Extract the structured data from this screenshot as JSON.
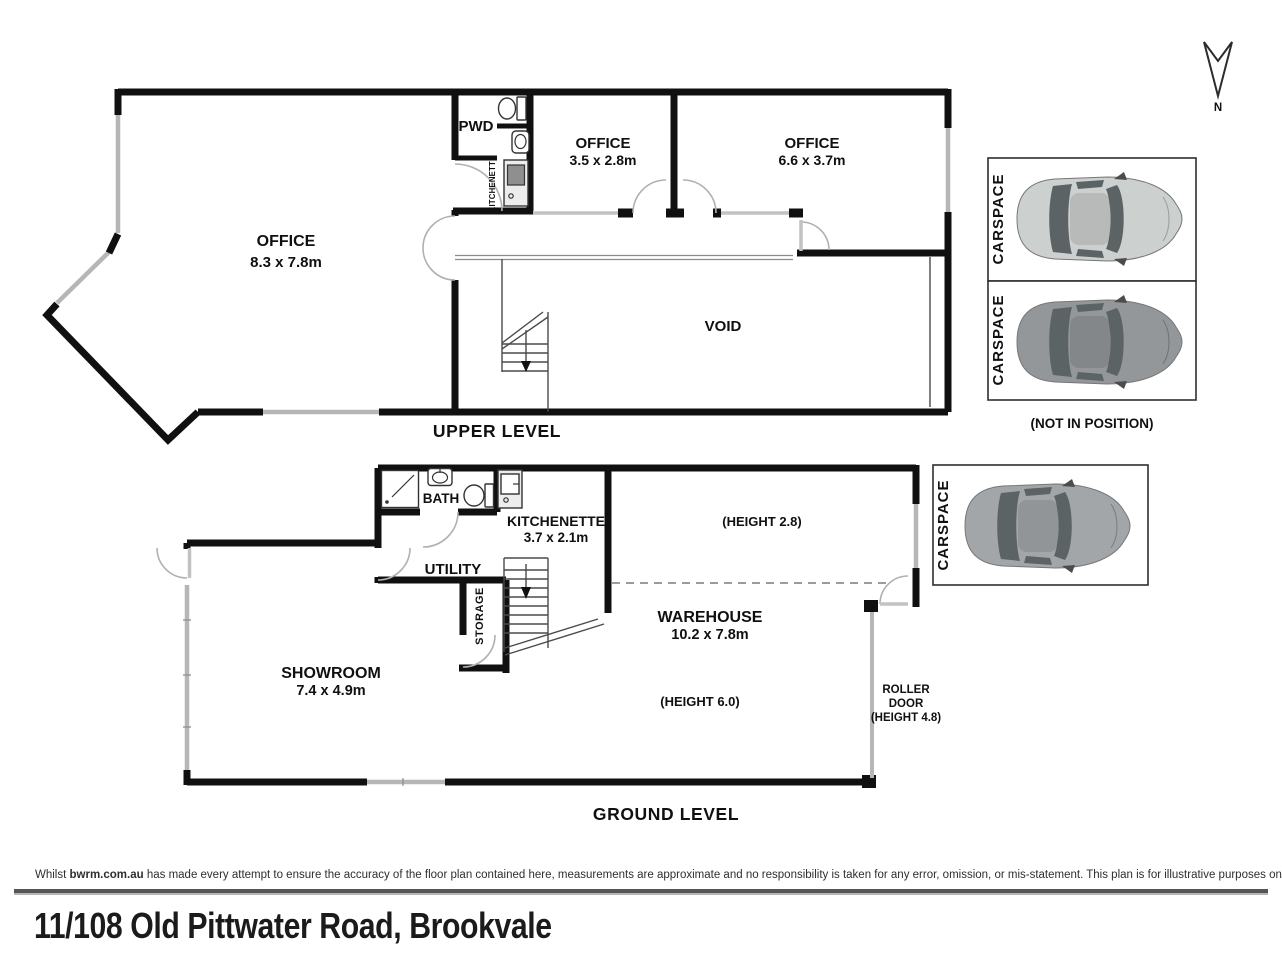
{
  "compass": {
    "label": "N"
  },
  "upper": {
    "caption": "UPPER LEVEL",
    "office_main": {
      "name": "OFFICE",
      "dims": "8.3 x 7.8m"
    },
    "office_small": {
      "name": "OFFICE",
      "dims": "3.5 x 2.8m"
    },
    "office_wide": {
      "name": "OFFICE",
      "dims": "6.6 x 3.7m"
    },
    "pwd": "PWD",
    "kitchenette": "KITCHENETTE",
    "void": "VOID",
    "carspace_top": "CARSPACE",
    "carspace_bottom": "CARSPACE",
    "not_in_position": "(NOT IN POSITION)"
  },
  "ground": {
    "caption": "GROUND LEVEL",
    "showroom": {
      "name": "SHOWROOM",
      "dims": "7.4 x 4.9m"
    },
    "warehouse": {
      "name": "WAREHOUSE",
      "dims": "10.2 x 7.8m"
    },
    "kitchenette": {
      "name": "KITCHENETTE",
      "dims": "3.7 x 2.1m"
    },
    "bath": "BATH",
    "utility": "UTILITY",
    "storage": "STORAGE",
    "height_note_upper": "(HEIGHT 2.8)",
    "height_note_main": "(HEIGHT 6.0)",
    "roller_door": {
      "line1": "ROLLER",
      "line2": "DOOR",
      "line3": "(HEIGHT 4.8)"
    },
    "carspace": "CARSPACE"
  },
  "footer": {
    "disclaimer_prefix": "Whilst ",
    "disclaimer_brand": "bwrm.com.au",
    "disclaimer_rest": " has made every attempt to ensure the accuracy of the floor plan contained here, measurements are approximate and no responsibility is taken for any error, omission, or mis-statement. This plan is for illustrative purposes only.",
    "address": "11/108 Old Pittwater Road, Brookvale"
  },
  "colors": {
    "wall": "#101010",
    "window": "#b6b6b6",
    "car_silver": "#ccd0cf",
    "car_dark_gray": "#93979a",
    "car_medium_gray": "#a2a6a9"
  }
}
